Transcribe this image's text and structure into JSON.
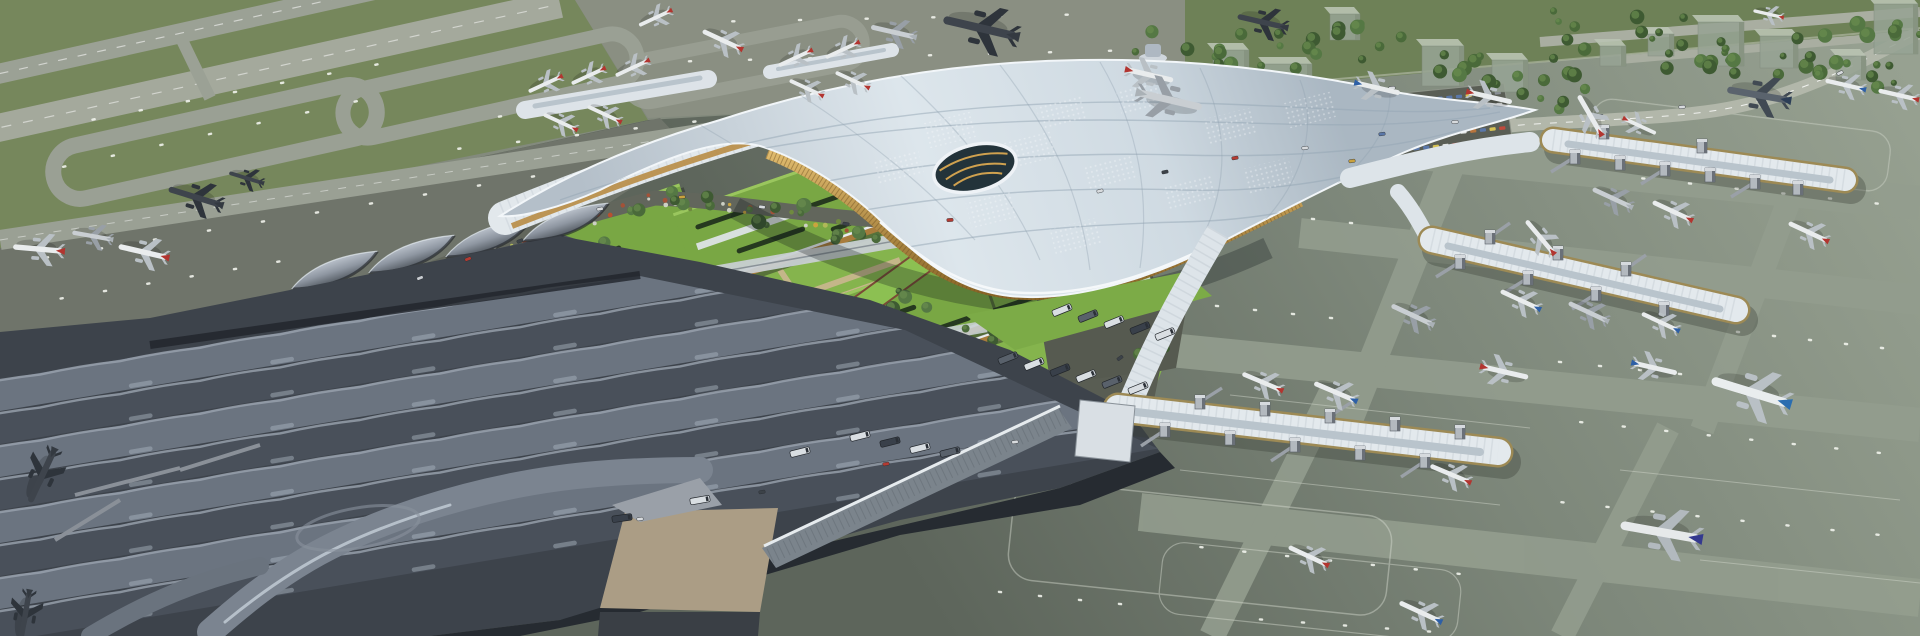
{
  "meta": {
    "description": "Aerial rendering of a large airport: curved white lattice-roof terminal, green-roofed landside blocks, dark wave-roof terminal at lower left, three gate piers with jet bridges at right, taxiway loops on grass at upper left, highway, parking lot and trees at upper right, many parked airliners.",
    "canvas": {
      "w": 1920,
      "h": 636
    }
  },
  "palette": {
    "ground": "#838a7d",
    "grass": "#76875c",
    "grassBand": "#6e8157",
    "apronLeft": "#6f746a",
    "apronTop": "#8a8f82",
    "apronRightLight": "#97a191",
    "apronRightDark": "#5d655b",
    "lane": "#939d8e",
    "taxiway": "#9aa094",
    "runway": "#a4a99c",
    "dash": "#f1f3ec",
    "roofLight": "#dde6ec",
    "roofMid": "#c2cdd5",
    "roofDark": "#aab7c2",
    "terminalDark": "#3d434b",
    "waveLight": "#6b7480",
    "waveDark": "#49505a",
    "crest": "#9aa3ae",
    "gold": "#c19a52",
    "goldDark": "#8a6527",
    "greenRoof": "#79a744",
    "greenRoofLight": "#9ac65e",
    "lawn": "#85b44d",
    "ramp": "#8cc052",
    "pathTan": "#cbb691",
    "road": "#62665c",
    "roadLight": "#b2b7aa",
    "glassDark": "#262b31",
    "plaza": "#ab9d85",
    "pierRoof": "#e3e9ed",
    "pierGlass": "#9d8a55",
    "towerBox": "#b3b9bf",
    "treeDark": "#3e5a32",
    "treeMid": "#4a6a3a",
    "treeLight": "#557844",
    "busDark": "#39404a",
    "white": "#eef2f6"
  },
  "plane_colors": {
    "red": {
      "body": "#e9eced",
      "wing": "#b9c0c5",
      "tail": "#b23530"
    },
    "blue": {
      "body": "#e9eced",
      "wing": "#b9c0c5",
      "tail": "#2d5fa6"
    },
    "navy": {
      "body": "#e6e9ea",
      "wing": "#b2b9be",
      "tail": "#34398f"
    },
    "korean": {
      "body": "#e9edee",
      "wing": "#b9c0c5",
      "tail": "#2b6db0"
    },
    "grey": {
      "body": "#c9ced2",
      "wing": "#989fa6",
      "tail": "#aab1b6"
    },
    "dark": {
      "body": "#3e444c",
      "wing": "#2e343b",
      "tail": "#343a41"
    },
    "darkblue": {
      "body": "#5a636d",
      "wing": "#414a53",
      "tail": "#2c3e57"
    }
  },
  "scene": {
    "planes": [
      [
        195,
        197,
        197,
        1.1,
        "dark"
      ],
      [
        246,
        178,
        197,
        0.7,
        "dark"
      ],
      [
        38,
        249,
        185,
        1.0,
        "red"
      ],
      [
        92,
        236,
        190,
        0.8,
        "grey"
      ],
      [
        143,
        252,
        193,
        1.0,
        "red"
      ],
      [
        42,
        476,
        115,
        1.15,
        "dark"
      ],
      [
        25,
        616,
        100,
        1.0,
        "dark"
      ],
      [
        545,
        84,
        155,
        0.72,
        "red"
      ],
      [
        588,
        76,
        155,
        0.72,
        "red"
      ],
      [
        632,
        68,
        155,
        0.72,
        "red"
      ],
      [
        560,
        122,
        205,
        0.72,
        "red"
      ],
      [
        604,
        114,
        205,
        0.72,
        "red"
      ],
      [
        795,
        58,
        155,
        0.72,
        "red"
      ],
      [
        842,
        50,
        155,
        0.72,
        "red"
      ],
      [
        806,
        88,
        205,
        0.72,
        "red"
      ],
      [
        852,
        80,
        205,
        0.72,
        "red"
      ],
      [
        980,
        28,
        193,
        1.5,
        "dark"
      ],
      [
        1262,
        22,
        193,
        1.0,
        "dark"
      ],
      [
        893,
        32,
        193,
        0.9,
        "grey"
      ],
      [
        722,
        40,
        205,
        0.85,
        "red"
      ],
      [
        655,
        18,
        155,
        0.7,
        "red"
      ],
      [
        1150,
        75,
        13,
        0.95,
        "red"
      ],
      [
        1378,
        88,
        13,
        0.9,
        "blue"
      ],
      [
        1490,
        97,
        13,
        0.9,
        "red"
      ],
      [
        1170,
        100,
        13,
        1.3,
        "grey"
      ],
      [
        1590,
        115,
        240,
        0.9,
        "red"
      ],
      [
        1758,
        95,
        190,
        1.25,
        "darkblue"
      ],
      [
        1845,
        85,
        193,
        0.8,
        "blue"
      ],
      [
        1898,
        95,
        193,
        0.8,
        "red"
      ],
      [
        1612,
        198,
        205,
        0.85,
        "grey"
      ],
      [
        1672,
        211,
        205,
        0.85,
        "red"
      ],
      [
        1808,
        232,
        205,
        0.85,
        "red"
      ],
      [
        1540,
        237,
        230,
        0.85,
        "red"
      ],
      [
        1520,
        300,
        205,
        0.85,
        "blue"
      ],
      [
        1588,
        312,
        205,
        0.85,
        "grey"
      ],
      [
        1660,
        322,
        205,
        0.8,
        "blue"
      ],
      [
        1412,
        315,
        205,
        0.9,
        "grey"
      ],
      [
        1505,
        372,
        13,
        0.95,
        "red"
      ],
      [
        1655,
        368,
        13,
        0.9,
        "blue"
      ],
      [
        1750,
        392,
        197,
        1.6,
        "korean"
      ],
      [
        1262,
        382,
        203,
        0.85,
        "red"
      ],
      [
        1335,
        392,
        203,
        0.9,
        "blue"
      ],
      [
        1450,
        474,
        203,
        0.85,
        "red"
      ],
      [
        1660,
        532,
        190,
        1.6,
        "navy"
      ],
      [
        1420,
        612,
        205,
        0.9,
        "blue"
      ],
      [
        1308,
        556,
        205,
        0.85,
        "red"
      ],
      [
        1768,
        14,
        193,
        0.6,
        "red"
      ],
      [
        1640,
        126,
        25,
        0.7,
        "red"
      ]
    ],
    "dash_lines": [
      [
        20,
        262,
        560,
        172,
        10
      ],
      [
        40,
        302,
        300,
        258,
        6
      ],
      [
        430,
        152,
        900,
        98,
        8
      ],
      [
        660,
        62,
        1140,
        50,
        8
      ],
      [
        700,
        22,
        1100,
        14,
        6
      ],
      [
        1195,
        120,
        1455,
        147,
        6
      ],
      [
        1620,
        176,
        1900,
        206,
        6
      ],
      [
        1180,
        205,
        1370,
        225,
        5
      ],
      [
        1160,
        300,
        1350,
        320,
        5
      ],
      [
        1720,
        330,
        1900,
        350,
        5
      ],
      [
        1540,
        360,
        1700,
        376,
        4
      ],
      [
        1560,
        420,
        1900,
        455,
        8
      ],
      [
        1180,
        545,
        1480,
        576,
        7
      ],
      [
        1540,
        500,
        1900,
        537,
        8
      ],
      [
        1240,
        618,
        1450,
        633,
        5
      ],
      [
        980,
        590,
        1140,
        606,
        4
      ],
      [
        40,
        172,
        380,
        96,
        7
      ],
      [
        70,
        124,
        400,
        60,
        7
      ],
      [
        480,
        120,
        640,
        92,
        4
      ]
    ],
    "wave_skylights": [
      [
        70,
        396,
        1060,
        231,
        7
      ],
      [
        70,
        429,
        1060,
        264,
        7
      ],
      [
        70,
        462,
        1060,
        297,
        7
      ],
      [
        70,
        495,
        1060,
        330,
        7
      ],
      [
        70,
        528,
        1060,
        363,
        7
      ],
      [
        70,
        561,
        1060,
        396,
        7
      ],
      [
        70,
        594,
        1060,
        429,
        7
      ],
      [
        70,
        627,
        1060,
        462,
        7
      ]
    ],
    "waves": {
      "rows": 8,
      "y0": 402,
      "dy": 33,
      "x0": -40,
      "len": 17
    },
    "trees": [
      [
        1205,
        62,
        16,
        75,
        32
      ],
      [
        1345,
        50,
        12,
        65,
        26
      ],
      [
        1475,
        65,
        9,
        48,
        20
      ],
      [
        1555,
        90,
        8,
        38,
        22
      ],
      [
        1615,
        35,
        12,
        70,
        24
      ],
      [
        1700,
        60,
        8,
        40,
        18
      ],
      [
        1775,
        55,
        10,
        55,
        20
      ],
      [
        1855,
        78,
        8,
        45,
        16
      ],
      [
        1885,
        30,
        6,
        35,
        14
      ],
      [
        1250,
        135,
        7,
        45,
        14
      ],
      [
        1310,
        168,
        6,
        40,
        12
      ],
      [
        1180,
        108,
        6,
        35,
        14
      ],
      [
        455,
        295,
        7,
        55,
        16
      ],
      [
        560,
        240,
        7,
        55,
        14
      ],
      [
        660,
        200,
        8,
        60,
        12
      ],
      [
        780,
        215,
        6,
        45,
        10
      ],
      [
        870,
        235,
        5,
        35,
        10
      ],
      [
        700,
        435,
        8,
        70,
        12
      ],
      [
        850,
        465,
        7,
        60,
        12
      ],
      [
        560,
        520,
        6,
        60,
        12
      ],
      [
        960,
        445,
        5,
        40,
        10
      ],
      [
        1000,
        330,
        6,
        35,
        16
      ],
      [
        1100,
        300,
        5,
        28,
        12
      ],
      [
        1145,
        345,
        5,
        24,
        14
      ],
      [
        800,
        320,
        4,
        30,
        10
      ],
      [
        920,
        300,
        4,
        30,
        10
      ],
      [
        1020,
        325,
        4,
        40,
        8
      ],
      [
        1120,
        295,
        4,
        40,
        8
      ]
    ],
    "flower_segments": [
      [
        355,
        300,
        650,
        198,
        26
      ],
      [
        650,
        198,
        855,
        226,
        20
      ]
    ],
    "flower_colors": [
      "#c9a43e",
      "#b8502f",
      "#cdd0c4",
      "#6f8a3f",
      "#b0b858",
      "#a35238"
    ],
    "parking": {
      "x": 1362,
      "y": 106,
      "cols": 15,
      "rows": 5,
      "colStep": [
        9.7,
        -0.95
      ],
      "rowStep": [
        1.5,
        11.8
      ],
      "carW": 6.2,
      "carH": 3.4,
      "rot": -6,
      "colors": [
        "#c14a3c",
        "#d6c253",
        "#e2e4e2",
        "#5a77a8",
        "#8b9096",
        "#b8743c"
      ]
    },
    "bus_colors": [
      "#d9dee2",
      "#59616b",
      "#39404a",
      "#7b848d"
    ],
    "buses": [
      [
        1062,
        310,
        -22,
        0
      ],
      [
        1088,
        316,
        -22,
        1
      ],
      [
        1114,
        322,
        -22,
        0
      ],
      [
        1140,
        328,
        -22,
        2
      ],
      [
        1165,
        334,
        -22,
        0
      ],
      [
        1008,
        358,
        -22,
        1
      ],
      [
        1034,
        364,
        -22,
        0
      ],
      [
        1060,
        370,
        -22,
        2
      ],
      [
        1086,
        376,
        -22,
        0
      ],
      [
        1112,
        382,
        -22,
        1
      ],
      [
        1138,
        388,
        -22,
        0
      ],
      [
        860,
        436,
        -14,
        0
      ],
      [
        890,
        442,
        -14,
        2
      ],
      [
        920,
        448,
        -14,
        0
      ],
      [
        950,
        452,
        -14,
        1
      ],
      [
        800,
        452,
        -14,
        0
      ],
      [
        700,
        500,
        -10,
        0
      ],
      [
        622,
        518,
        -8,
        2
      ]
    ],
    "cars": [
      [
        420,
        278,
        -22,
        "#c9cdd2"
      ],
      [
        468,
        259,
        -22,
        "#b43b32"
      ],
      [
        520,
        241,
        -20,
        "#3c4248"
      ],
      [
        600,
        209,
        -12,
        "#d8dbde"
      ],
      [
        682,
        197,
        -5,
        "#caa23e"
      ],
      [
        762,
        207,
        8,
        "#d8dbde"
      ],
      [
        846,
        224,
        10,
        "#3c4248"
      ],
      [
        950,
        220,
        -4,
        "#b43b32"
      ],
      [
        1100,
        191,
        -15,
        "#d8dbde"
      ],
      [
        1165,
        172,
        -12,
        "#3c4248"
      ],
      [
        1235,
        158,
        -10,
        "#b43b32"
      ],
      [
        1305,
        148,
        -8,
        "#d8dbde"
      ],
      [
        1382,
        134,
        -8,
        "#5a77a8"
      ],
      [
        1455,
        122,
        -5,
        "#d8dbde"
      ],
      [
        1600,
        116,
        -3,
        "#3c4248"
      ],
      [
        1682,
        107,
        -6,
        "#d8dbde"
      ],
      [
        1762,
        94,
        -18,
        "#b43b32"
      ],
      [
        1840,
        73,
        -25,
        "#d8dbde"
      ],
      [
        1352,
        161,
        -8,
        "#caa23e"
      ],
      [
        1392,
        88,
        -5,
        "#d8dbde"
      ],
      [
        640,
        519,
        -8,
        "#d8dbde"
      ],
      [
        762,
        492,
        -10,
        "#3c4248"
      ],
      [
        886,
        464,
        -10,
        "#b43b32"
      ],
      [
        1015,
        442,
        -8,
        "#d8dbde"
      ],
      [
        1120,
        358,
        -35,
        "#3c4248"
      ]
    ],
    "buildings": [
      [
        1213,
        50,
        36,
        42
      ],
      [
        1264,
        64,
        48,
        38
      ],
      [
        1330,
        14,
        30,
        26
      ],
      [
        1422,
        46,
        42,
        40
      ],
      [
        1492,
        60,
        36,
        32
      ],
      [
        1600,
        46,
        26,
        20
      ],
      [
        1648,
        34,
        26,
        22
      ],
      [
        1698,
        22,
        46,
        44
      ],
      [
        1760,
        36,
        38,
        32
      ],
      [
        1874,
        4,
        44,
        50
      ],
      [
        1836,
        56,
        30,
        24
      ],
      [
        1176,
        90,
        58,
        26
      ]
    ],
    "green_blocks": [
      [
        575,
        268,
        252,
        92,
        1
      ],
      [
        800,
        214,
        240,
        84,
        1
      ],
      [
        1030,
        282,
        230,
        86,
        0
      ],
      [
        645,
        358,
        250,
        88,
        0
      ],
      [
        872,
        326,
        240,
        80,
        1
      ],
      [
        820,
        398,
        210,
        74,
        0
      ]
    ],
    "pier_towers": {
      "A": [
        [
          1575,
          157,
          -24,
          15
        ],
        [
          1620,
          163,
          0,
          0
        ],
        [
          1665,
          169,
          -24,
          15
        ],
        [
          1710,
          175,
          0,
          0
        ],
        [
          1755,
          182,
          -24,
          15
        ],
        [
          1798,
          188,
          0,
          0
        ],
        [
          1604,
          132,
          0,
          0
        ],
        [
          1702,
          146,
          0,
          0
        ]
      ],
      "B": [
        [
          1490,
          237,
          20,
          -14
        ],
        [
          1558,
          253,
          0,
          0
        ],
        [
          1626,
          269,
          20,
          -14
        ],
        [
          1460,
          262,
          -24,
          15
        ],
        [
          1528,
          278,
          -24,
          15
        ],
        [
          1596,
          294,
          -24,
          15
        ],
        [
          1664,
          309,
          0,
          0
        ]
      ],
      "C": [
        [
          1165,
          430,
          -24,
          16
        ],
        [
          1230,
          438,
          0,
          0
        ],
        [
          1295,
          445,
          -24,
          16
        ],
        [
          1360,
          453,
          0,
          0
        ],
        [
          1425,
          461,
          -24,
          16
        ],
        [
          1200,
          402,
          22,
          -14
        ],
        [
          1265,
          409,
          0,
          0
        ],
        [
          1330,
          416,
          22,
          -14
        ],
        [
          1395,
          424,
          0,
          0
        ],
        [
          1460,
          432,
          0,
          0
        ]
      ]
    },
    "perf_patches": [
      [
        950,
        130
      ],
      [
        1030,
        150
      ],
      [
        1110,
        172
      ],
      [
        1190,
        192
      ],
      [
        1268,
        176
      ],
      [
        1062,
        112
      ],
      [
        1142,
        97
      ],
      [
        992,
        210
      ],
      [
        1076,
        236
      ],
      [
        1230,
        126
      ],
      [
        1310,
        110
      ],
      [
        898,
        168
      ]
    ]
  }
}
